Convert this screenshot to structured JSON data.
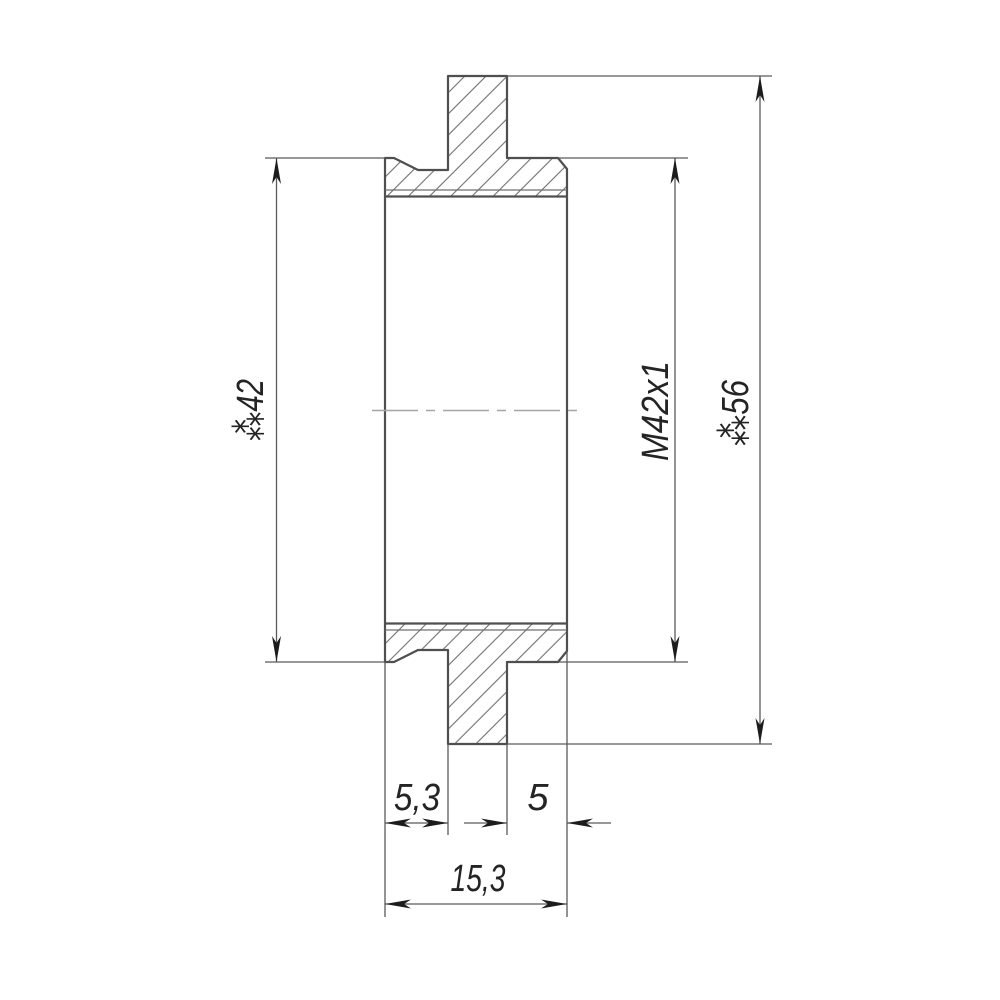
{
  "drawing": {
    "kind": "mechanical-part-cross-section",
    "description": "Sectioned side view of a flanged threaded adapter ring with hatched cut surfaces, center axis line and dimension callouts",
    "labels": {
      "dia_body": "⁂42",
      "thread_spec": "M42x1",
      "dia_flange": "⁂56",
      "width_left_step": "5,3",
      "width_right_step": "5",
      "width_total": "15,3"
    },
    "values": {
      "body_diameter_mm": 42,
      "thread": "M42x1",
      "flange_diameter_mm": 56,
      "left_step_width_mm": 5.3,
      "right_step_width_mm": 5,
      "total_width_mm": 15.3
    },
    "colors": {
      "background": "#ffffff",
      "outline": "#4f4f4f",
      "dimension_lines": "#5a5a5a",
      "hatch": "#707070",
      "centerline": "#a5a5a5",
      "arrows_and_text": "#1c1c1c"
    }
  }
}
